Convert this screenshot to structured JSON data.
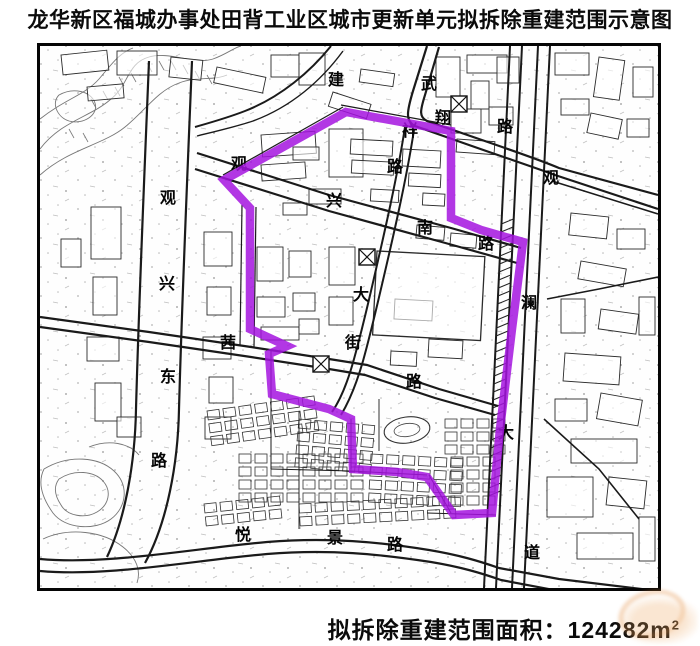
{
  "title": "龙华新区福城办事处田背工业区城市更新单元拟拆除重建范围示意图",
  "caption": {
    "label": "拟拆除重建范围面积：",
    "value": "124282m",
    "sup": "2"
  },
  "map": {
    "boundary_color": "#a414df",
    "boundary_points": "347,113 452,132 452,219 482,231 524,243 513,330 501,430 493,514 455,516 428,478 398,473 354,470 352,420 330,410 273,395 270,355 288,347 251,330 251,209 225,181",
    "street_labels": [
      {
        "text": "建",
        "x": 337,
        "y": 86
      },
      {
        "text": "武",
        "x": 430,
        "y": 90
      },
      {
        "text": "翔",
        "x": 444,
        "y": 124
      },
      {
        "text": "路",
        "x": 506,
        "y": 133
      },
      {
        "text": "祥",
        "x": 411,
        "y": 137
      },
      {
        "text": "路",
        "x": 396,
        "y": 173
      },
      {
        "text": "观",
        "x": 240,
        "y": 170
      },
      {
        "text": "兴",
        "x": 335,
        "y": 207
      },
      {
        "text": "南",
        "x": 426,
        "y": 234
      },
      {
        "text": "路",
        "x": 487,
        "y": 250
      },
      {
        "text": "观",
        "x": 552,
        "y": 184
      },
      {
        "text": "澜",
        "x": 530,
        "y": 309
      },
      {
        "text": "大",
        "x": 507,
        "y": 439
      },
      {
        "text": "道",
        "x": 533,
        "y": 559
      },
      {
        "text": "观",
        "x": 169,
        "y": 204
      },
      {
        "text": "兴",
        "x": 168,
        "y": 290
      },
      {
        "text": "东",
        "x": 169,
        "y": 383
      },
      {
        "text": "路",
        "x": 160,
        "y": 467
      },
      {
        "text": "大",
        "x": 362,
        "y": 301
      },
      {
        "text": "街",
        "x": 354,
        "y": 349
      },
      {
        "text": "茜",
        "x": 229,
        "y": 349
      },
      {
        "text": "路",
        "x": 415,
        "y": 388
      },
      {
        "text": "悦",
        "x": 244,
        "y": 541
      },
      {
        "text": "景",
        "x": 336,
        "y": 544
      },
      {
        "text": "路",
        "x": 396,
        "y": 551
      }
    ],
    "junction_markers": [
      {
        "x": 360,
        "y": 250
      },
      {
        "x": 314,
        "y": 357
      },
      {
        "x": 452,
        "y": 97
      }
    ]
  },
  "watermark": {
    "color": "#e89a4e"
  }
}
